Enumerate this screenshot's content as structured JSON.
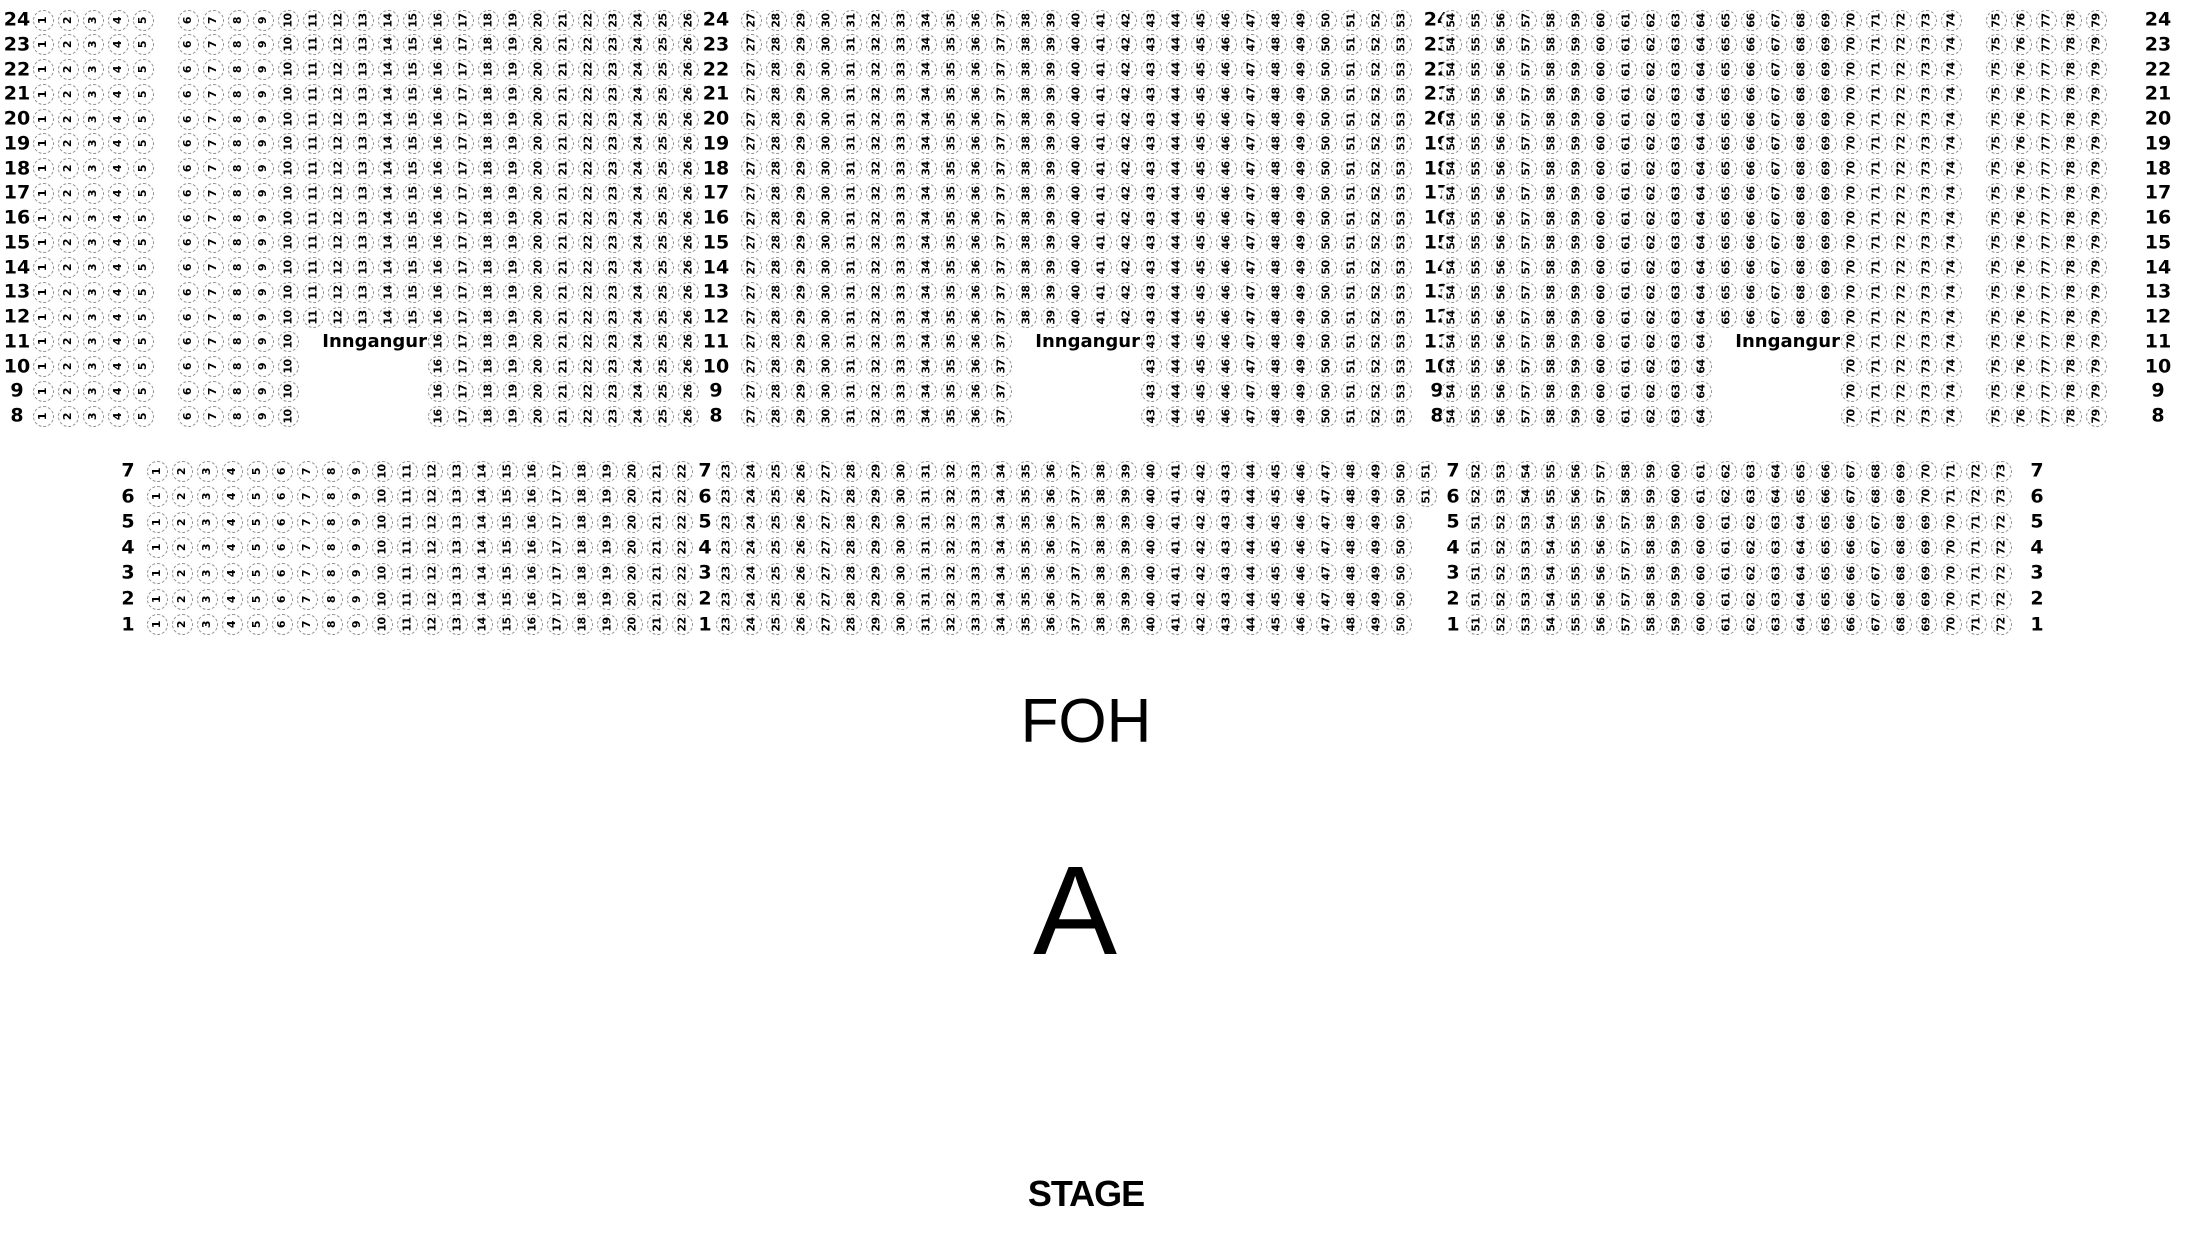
{
  "venue": {
    "entrance_label": "Inngangur",
    "foh_label": "FOH",
    "section_label": "A",
    "stage_label": "STAGE"
  },
  "colors": {
    "background": "#ffffff",
    "seat_outline": "#8c8c8c",
    "text": "#000000"
  },
  "upper_block": {
    "rows": [
      24,
      23,
      22,
      21,
      20,
      19,
      18,
      17,
      16,
      15,
      14,
      13,
      12,
      11,
      10,
      9,
      8
    ],
    "row_groups": [
      {
        "row_from": 24,
        "row_to": 12,
        "segments": [
          [
            1,
            26
          ],
          [
            27,
            53
          ],
          [
            54,
            79
          ]
        ]
      },
      {
        "row_from": 11,
        "row_to": 8,
        "segments": [
          [
            1,
            10
          ],
          [
            16,
            37
          ],
          [
            43,
            64
          ],
          [
            70,
            79
          ]
        ]
      }
    ],
    "aisle_before_seat": {
      "6": 20,
      "27": 38,
      "54": 25,
      "75": 20
    },
    "entrances": [
      {
        "row": 11,
        "before_seat": 16
      },
      {
        "row": 11,
        "before_seat": 43
      },
      {
        "row": 11,
        "before_seat": 70
      }
    ]
  },
  "lower_block": {
    "rows": [
      7,
      6,
      5,
      4,
      3,
      2,
      1
    ],
    "row_groups": [
      {
        "row_from": 7,
        "row_to": 6,
        "segments": [
          [
            1,
            22
          ],
          [
            23,
            51
          ],
          [
            52,
            73
          ]
        ],
        "aisle_before_seat": {
          "23": 19,
          "52": 25
        }
      },
      {
        "row_from": 5,
        "row_to": 1,
        "segments": [
          [
            1,
            22
          ],
          [
            23,
            50
          ],
          [
            51,
            72
          ]
        ],
        "aisle_before_seat": {
          "23": 19,
          "51": 50
        }
      }
    ]
  }
}
